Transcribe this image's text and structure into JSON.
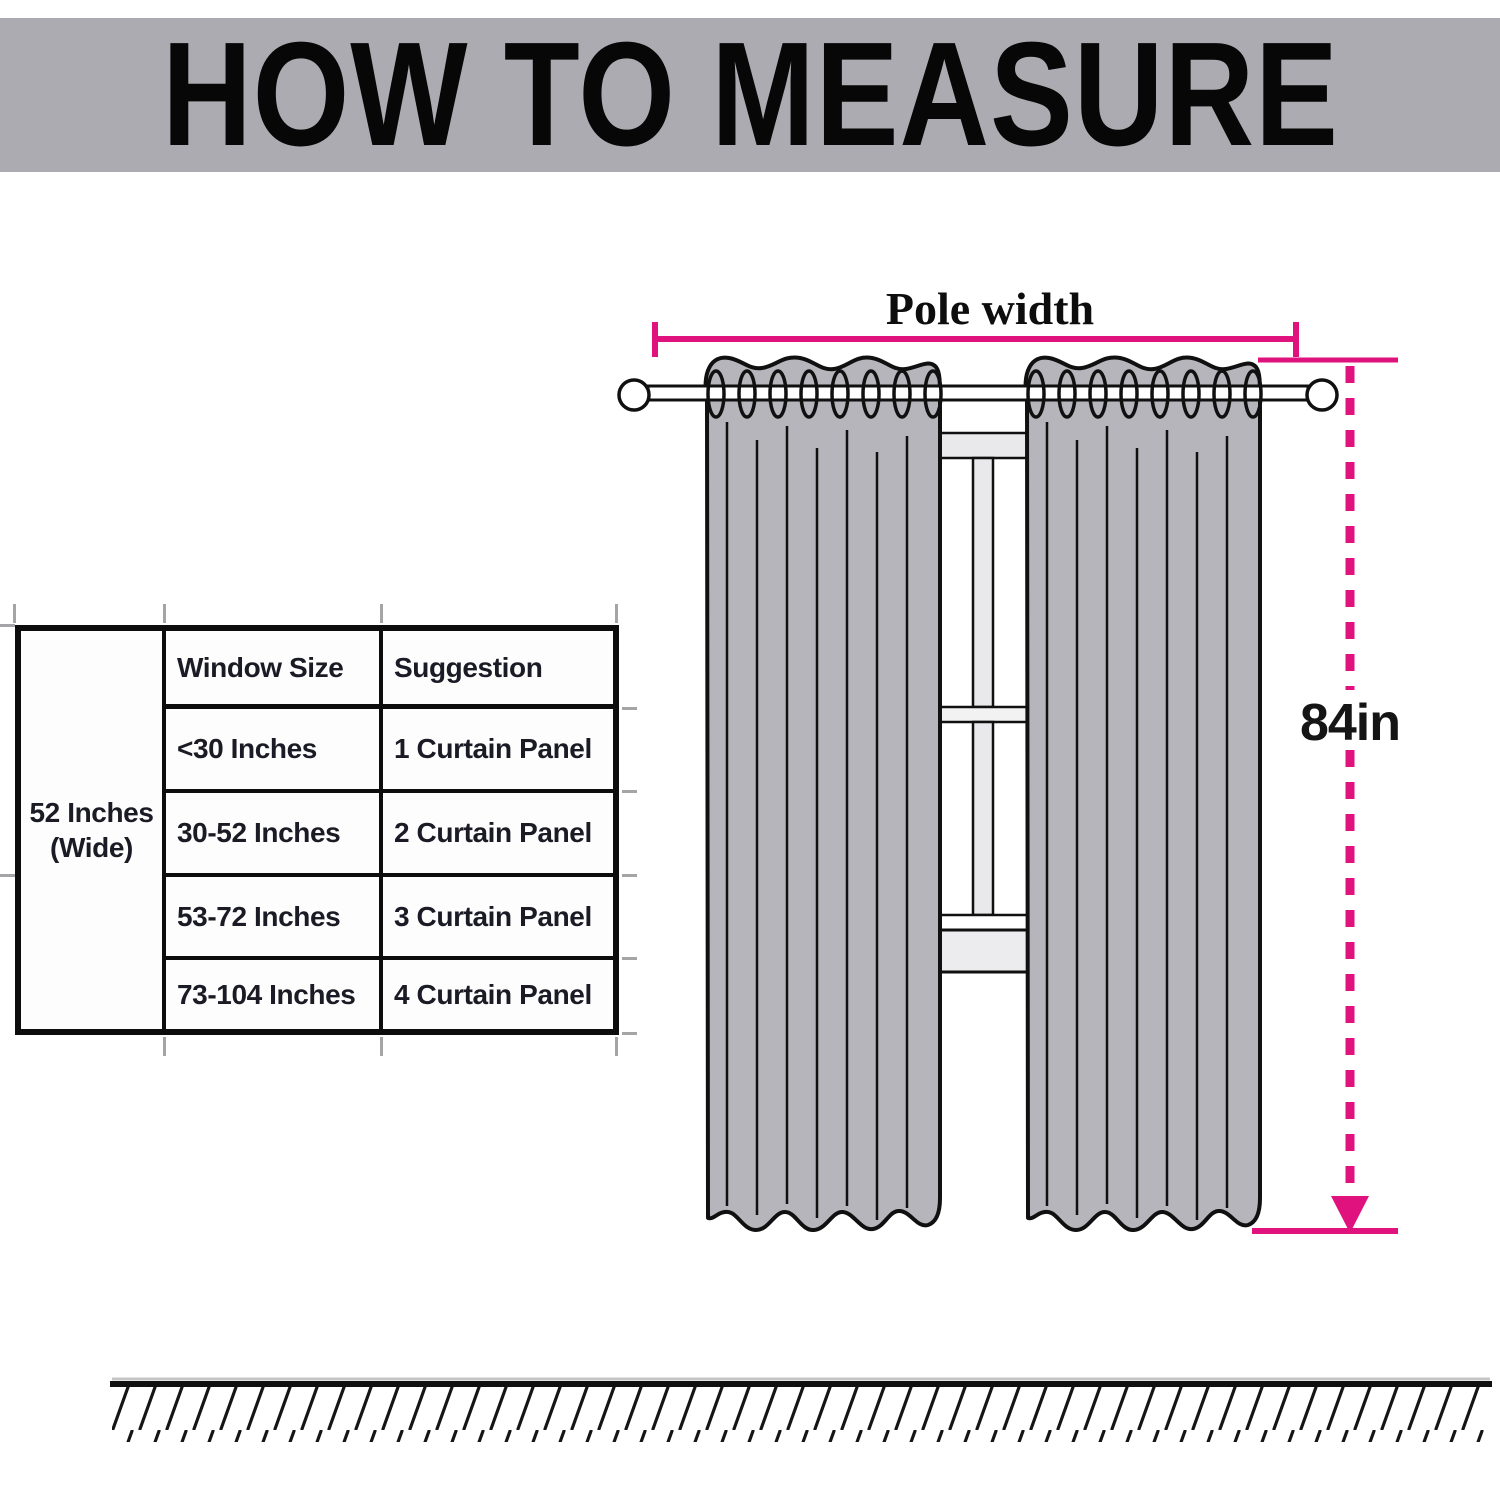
{
  "header": {
    "title": "HOW TO MEASURE"
  },
  "size_table": {
    "width_label": "52 Inches (Wide)",
    "columns": {
      "window_size": "Window Size",
      "suggestion": "Suggestion"
    },
    "rows": [
      {
        "window_size": "<30 Inches",
        "suggestion": "1 Curtain Panel"
      },
      {
        "window_size": "30-52 Inches",
        "suggestion": "2 Curtain Panel"
      },
      {
        "window_size": "53-72 Inches",
        "suggestion": "3 Curtain Panel"
      },
      {
        "window_size": "73-104 Inches",
        "suggestion": "4 Curtain Panel"
      }
    ]
  },
  "diagram": {
    "pole_width_label": "Pole width",
    "curtain_length_label": "84in"
  },
  "colors": {
    "accent_magenta": "#E0127E",
    "header_band": "#ABABB1",
    "curtain_gray": "#B5B5BB",
    "window_frame_gray": "#E9E9EB",
    "table_text": "#1B1B25"
  }
}
